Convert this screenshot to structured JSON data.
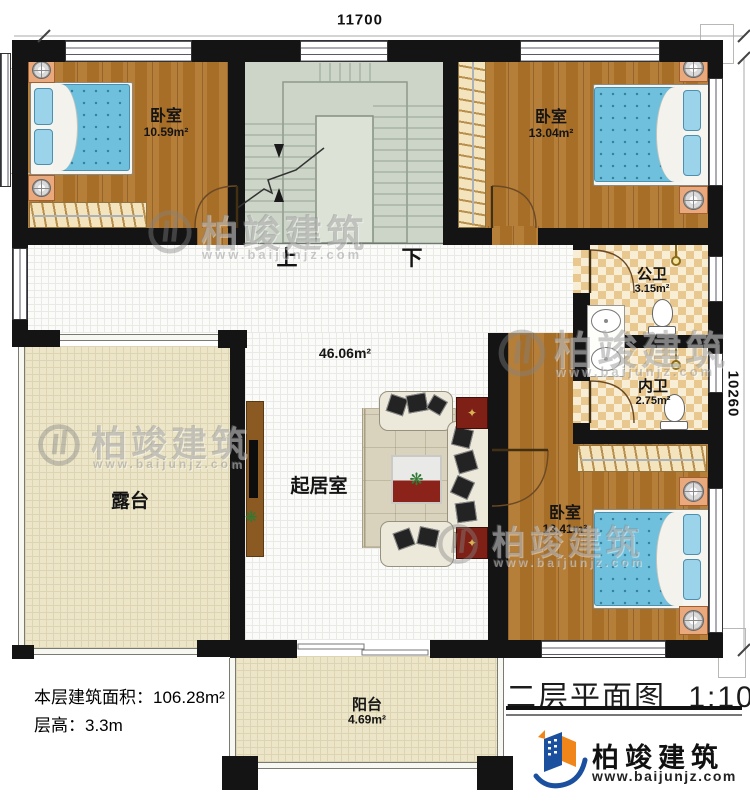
{
  "plan": {
    "dim_top": "11700",
    "dim_right": "10260",
    "stair_up": "上",
    "stair_down": "下",
    "rooms": {
      "bedroom_nw": {
        "name": "卧室",
        "area": "10.59m²"
      },
      "bedroom_ne": {
        "name": "卧室",
        "area": "13.04m²"
      },
      "bath_public": {
        "name": "公卫",
        "area": "3.15m²"
      },
      "bath_inner": {
        "name": "内卫",
        "area": "2.75m²"
      },
      "bedroom_se": {
        "name": "卧室",
        "area": "13.41m²"
      },
      "living": {
        "name": "起居室",
        "area": "46.06m²"
      },
      "terrace": {
        "name": "露台"
      },
      "balcony": {
        "name": "阳台",
        "area": "4.69m²"
      }
    }
  },
  "annotations": {
    "floor_area": "本层建筑面积：106.28m²",
    "floor_height": "层高：3.3m"
  },
  "titleblock": {
    "title": "二层平面图",
    "scale": "1:100"
  },
  "brand": {
    "name": "柏竣建筑",
    "site": "www.baijunjz.com"
  },
  "watermark": {
    "name": "柏竣建筑",
    "site": "www.baijunjz.com"
  },
  "colors": {
    "wall": "#141414",
    "wood_floor": "#b1752a",
    "tile_floor": "#fbfbfa",
    "stair": "#cdd5c8",
    "outdoor": "#ece5c8",
    "bath_tile": "#e8c88e",
    "mattress": "#6fc0dc",
    "brand_blue": "#1b509e",
    "brand_orange": "#f08519"
  }
}
